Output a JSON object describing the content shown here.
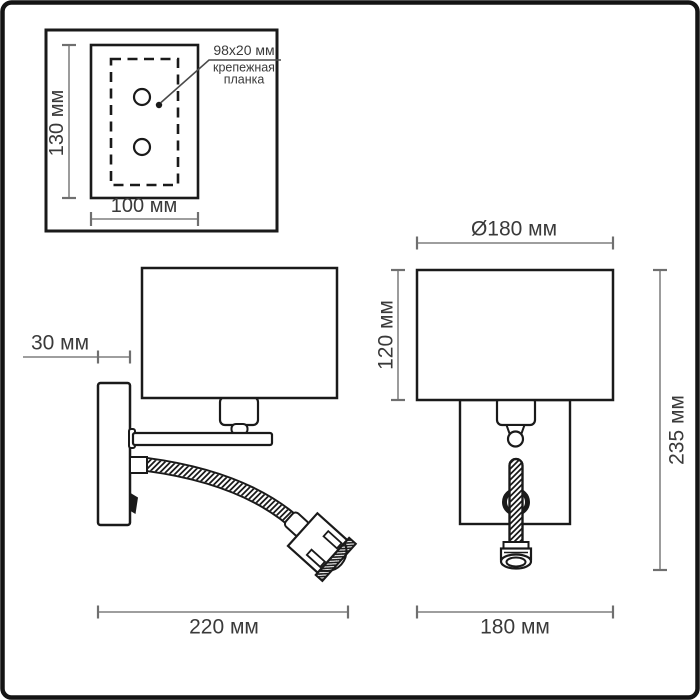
{
  "colors": {
    "outline": "#1a1a1a",
    "dimension_line": "#919191",
    "text": "#3a3a3a",
    "background": "#ffffff"
  },
  "detail_inset": {
    "plate_height": "130 мм",
    "plate_width": "100 мм",
    "callout_size": "98x20 мм",
    "callout_word1": "крепежная",
    "callout_word2": "планка"
  },
  "side_view": {
    "wall_offset": "30 мм",
    "depth": "220 мм"
  },
  "front_view": {
    "shade_diameter": "Ø180 мм",
    "shade_height": "120 мм",
    "total_height": "235 мм",
    "width": "180 мм"
  }
}
